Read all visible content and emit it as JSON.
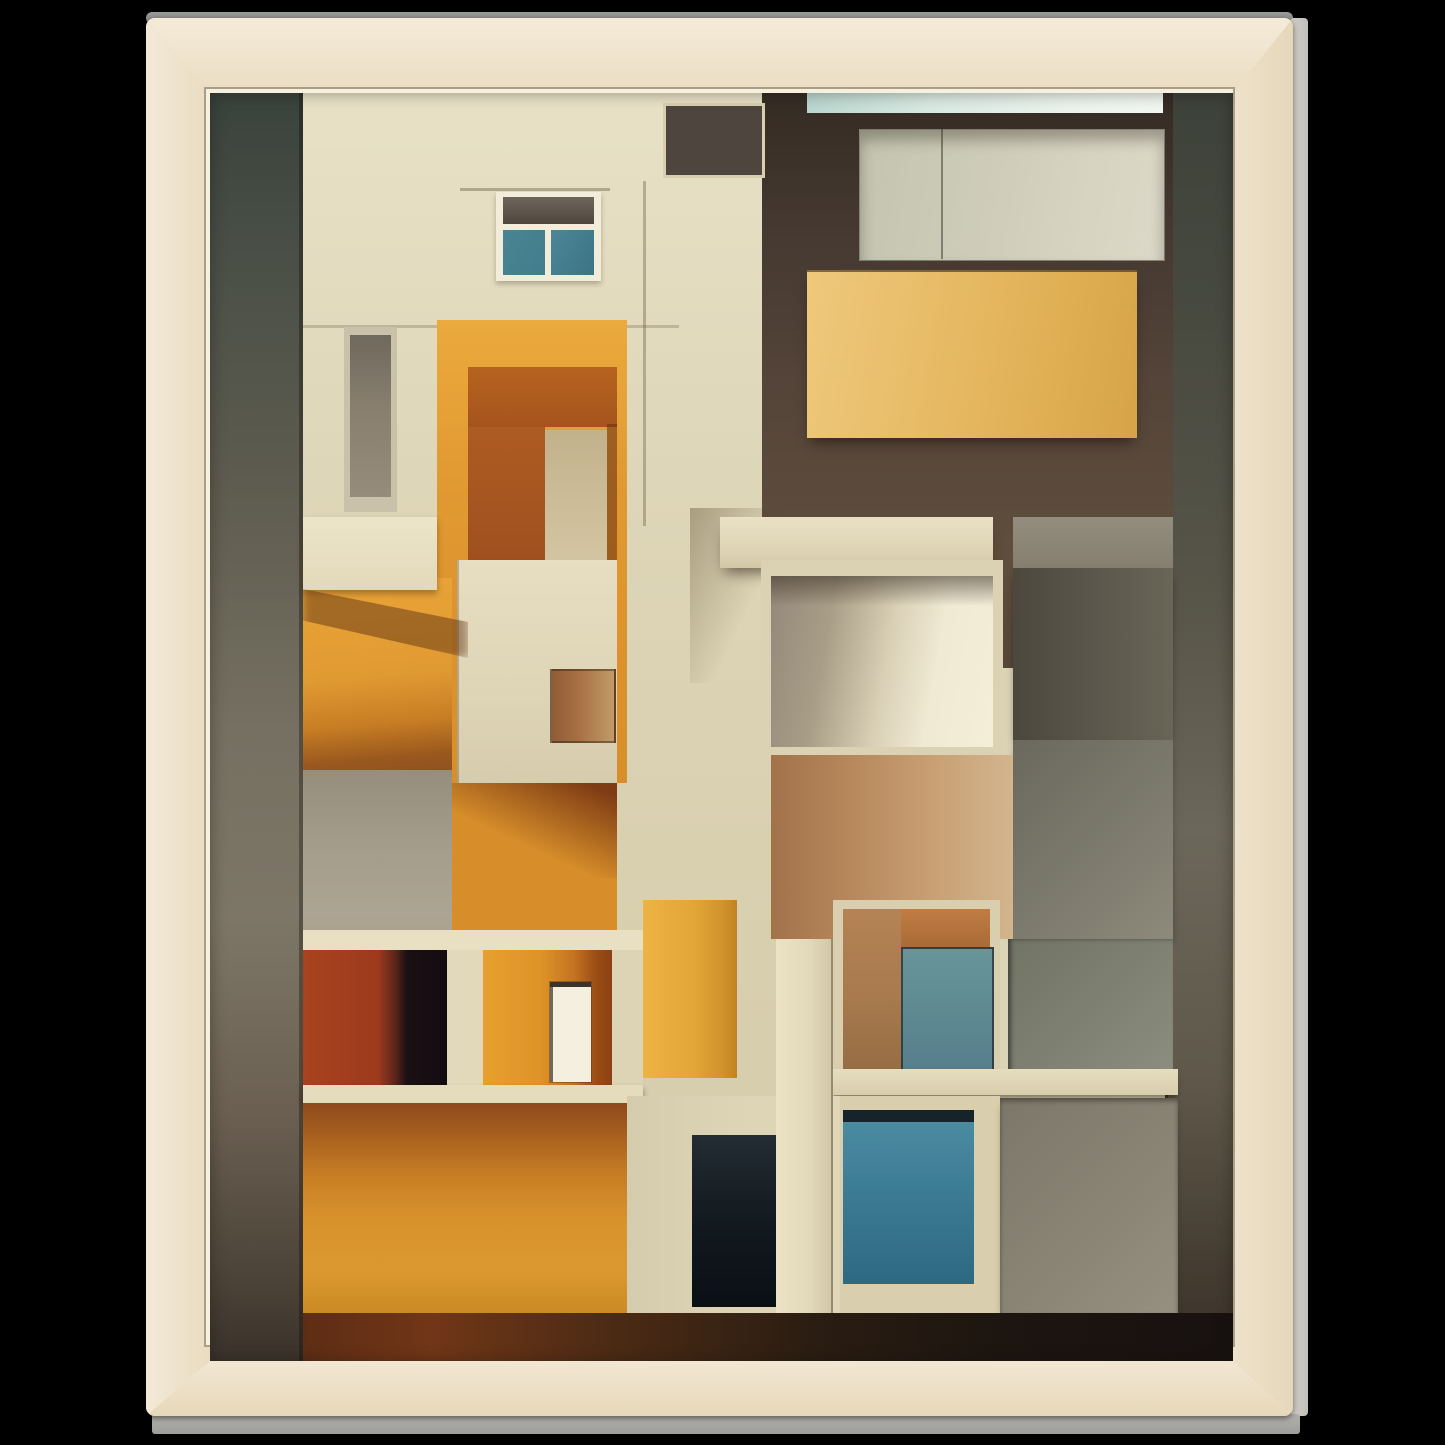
{
  "meta": {
    "kind": "framed-art-print-mockup",
    "background": "#000000"
  },
  "frame": {
    "wood_base": "#efe4cf",
    "wood_grain_dark": "#c79e72",
    "wood_grain_light": "#f8efe0",
    "top_edge_color": "#8e908d",
    "right_edge_color": "#c9c6c1",
    "bottom_edge_color": "#a7a6a3",
    "bevel_color": "#f6f0df"
  },
  "artwork": {
    "palette": {
      "cream": "#ded6b8",
      "orange": "#d88e29",
      "burnt_orange": "#a5541e",
      "amber_panel": "#e0b056",
      "teal_glass": "#3d7c95",
      "slate_strip": "#4a4c42",
      "dark_brown": "#4a3c30",
      "concrete_gray": "#a49c8a",
      "near_black": "#120c10"
    },
    "blocks": [
      {
        "name": "cream-facade-base",
        "x": 93,
        "y": 0,
        "w": 479,
        "h": 1270,
        "bg": "linear-gradient(180deg,#e8e1c6 0%,#ded6b8 30%,#d9d0b0 60%,#d4cba9 100%)",
        "cls": "grain-vsoft"
      },
      {
        "name": "left-sky-strip",
        "x": 0,
        "y": 0,
        "w": 93,
        "h": 1270,
        "bg": "linear-gradient(180deg,#39423c 0%,#494f46 12%,#5d5b4f 30%,#757061 50%,#7d7667 65%,#6b6052 80%,#4f463b 92%,#3a322a 100%)"
      },
      {
        "name": "left-strip-seam",
        "x": 89,
        "y": 0,
        "w": 4,
        "h": 1270,
        "bg": "rgba(15,15,10,0.35)"
      },
      {
        "name": "right-sky-strip",
        "x": 955,
        "y": 0,
        "w": 68,
        "h": 1270,
        "bg": "linear-gradient(180deg,#3d423a 0%,#484a40 18%,#585549 40%,#6b675a 58%,#5f584a 78%,#453d32 92%,#3b332a 100%)"
      },
      {
        "name": "right-strip-seam",
        "x": 955,
        "y": 0,
        "w": 3,
        "h": 1270,
        "bg": "rgba(10,10,8,0.4)"
      },
      {
        "name": "upper-right-brown-wall",
        "x": 552,
        "y": 0,
        "w": 411,
        "h": 575,
        "bg": "linear-gradient(180deg,#342b23 0%,#443830 22%,#544439 50%,#5f4e3d 80%,#574738 100%)"
      },
      {
        "name": "brown-wall-planks",
        "x": 552,
        "y": 330,
        "w": 411,
        "h": 245,
        "bg": "rgba(0,0,0,0)",
        "cls": "planks"
      },
      {
        "name": "rooftop-ice-strip",
        "x": 597,
        "y": 0,
        "w": 356,
        "h": 20,
        "bg": "linear-gradient(90deg,#b9d6ce 0%,#d9e9e2 35%,#ecf3ed 75%,#f1f6f0 100%)"
      },
      {
        "name": "top-right-pale-panel",
        "x": 649,
        "y": 36,
        "w": 304,
        "h": 130,
        "bg": "linear-gradient(100deg,#c3c4af 0%,#cccbb7 35%,#d6d3c1 70%,#dcd9c8 100%)",
        "border": "1px solid rgba(50,45,35,0.5)",
        "shadow": "inset 0 10px 14px rgba(40,32,22,0.35)"
      },
      {
        "name": "pale-panel-seam",
        "x": 731,
        "y": 36,
        "w": 2,
        "h": 130,
        "bg": "rgba(55,50,40,0.5)"
      },
      {
        "name": "amber-balcony-panel",
        "x": 597,
        "y": 177,
        "w": 330,
        "h": 168,
        "bg": "linear-gradient(100deg,#efc87c 0%,#e7bb66 40%,#dfae52 75%,#d7a348 100%)",
        "shadow": "0 8px 12px -4px rgba(25,15,8,0.6), inset 0 2px 0 rgba(40,25,10,0.55)"
      },
      {
        "name": "gray-stack-band",
        "x": 803,
        "y": 424,
        "w": 160,
        "h": 51,
        "bg": "linear-gradient(180deg,#938d7e,#867f70)"
      },
      {
        "name": "gray-square-dark",
        "x": 803,
        "y": 475,
        "w": 160,
        "h": 172,
        "bg": "linear-gradient(90deg,#4c483e 0%,#59554a 45%,#696557 100%)",
        "cls": "hlines",
        "shadow": "0 6px 9px -3px rgba(0,0,0,0.55)"
      },
      {
        "name": "gray-square-light",
        "x": 803,
        "y": 647,
        "w": 160,
        "h": 199,
        "bg": "linear-gradient(135deg,#6b685d 0%,#7b786c 50%,#8d8a7b 100%)",
        "shadow": "0 6px 9px -3px rgba(0,0,0,0.5)"
      },
      {
        "name": "column-diagonal-shadow",
        "x": 480,
        "y": 415,
        "w": 95,
        "h": 175,
        "bg": "linear-gradient(115deg,rgba(85,65,40,0.38) 0%,rgba(85,65,40,0) 60%)"
      },
      {
        "name": "concrete-beam",
        "x": 510,
        "y": 424,
        "w": 273,
        "h": 51,
        "bg": "linear-gradient(180deg,#eae0c5 0%,#ddd3b4 70%,#d2c7a5 100%)",
        "shadow": "0 10px 14px -5px rgba(45,30,18,0.6)"
      },
      {
        "name": "alcove-frame",
        "x": 551,
        "y": 467,
        "w": 242,
        "h": 203,
        "bg": "#dbd1b3"
      },
      {
        "name": "alcove-interior",
        "x": 561,
        "y": 483,
        "w": 222,
        "h": 171,
        "bg": "linear-gradient(100deg,#94897a 0%,#a89d86 26%,#d9d0b6 52%,#f0e9d3 72%,#f4eed9 100%)"
      },
      {
        "name": "alcove-top-shade",
        "x": 561,
        "y": 483,
        "w": 222,
        "h": 30,
        "bg": "linear-gradient(180deg,rgba(58,48,36,0.55),rgba(58,48,36,0))"
      },
      {
        "name": "tan-brick-wall",
        "x": 561,
        "y": 662,
        "w": 242,
        "h": 184,
        "bg": "linear-gradient(90deg,#a2734b 0%,#b8895d 35%,#c9a276 70%,#d3b58d 100%)",
        "cls": "bricks"
      },
      {
        "name": "glass-mesh-square",
        "x": 798,
        "y": 846,
        "w": 165,
        "h": 143,
        "bg": "linear-gradient(135deg,#717464 0%,#7e8172 50%,#8c8e7f 100%)",
        "cls": "mesh",
        "shadow": "inset 3px 0 4px rgba(15,20,15,0.5)"
      },
      {
        "name": "window-b-frame",
        "x": 623,
        "y": 807,
        "w": 167,
        "h": 178,
        "bg": "#d9cfaf",
        "cls": "grain-vsoft"
      },
      {
        "name": "window-b-lintel",
        "x": 633,
        "y": 816,
        "w": 147,
        "h": 40,
        "bg": "linear-gradient(180deg,#c07d43 0%,#a96a36 100%)"
      },
      {
        "name": "window-b-tan-wall",
        "x": 633,
        "y": 816,
        "w": 58,
        "h": 160,
        "bg": "linear-gradient(180deg,#b48356 0%,#a87a4e 55%,#976d43 100%)"
      },
      {
        "name": "window-b-teal-pane",
        "x": 691,
        "y": 854,
        "w": 89,
        "h": 122,
        "bg": "linear-gradient(180deg,#679599 0%,#567e8b 100%)",
        "cls": "blinds",
        "border": "2px solid rgba(25,30,32,0.65)"
      },
      {
        "name": "window-sill-band",
        "x": 620,
        "y": 976,
        "w": 348,
        "h": 26,
        "bg": "linear-gradient(180deg,#e6ddbf 0%,#d8cead 100%)",
        "shadow": "0 5px 7px -2px rgba(25,20,12,0.55)"
      },
      {
        "name": "window-c-frame",
        "x": 620,
        "y": 1003,
        "w": 170,
        "h": 224,
        "bg": "#d9cfaf",
        "cls": "grain-vsoft"
      },
      {
        "name": "window-c-top-bar",
        "x": 633,
        "y": 1017,
        "w": 131,
        "h": 12,
        "bg": "#17232b"
      },
      {
        "name": "window-c-teal-glass",
        "x": 633,
        "y": 1029,
        "w": 131,
        "h": 162,
        "bg": "linear-gradient(180deg,#4b8ba1 0%,#3d7c95 40%,#2e6982 100%)"
      },
      {
        "name": "bottom-right-gray-panel",
        "x": 790,
        "y": 1005,
        "w": 178,
        "h": 215,
        "bg": "linear-gradient(135deg,#7d776a 0%,#8a8475 55%,#959080 100%)",
        "shadow": "inset 0 3px 5px rgba(30,25,18,0.45), 0 6px 8px -3px rgba(0,0,0,0.4)"
      },
      {
        "name": "window-a-ledge-line",
        "x": 250,
        "y": 95,
        "w": 150,
        "h": 3,
        "bg": "rgba(95,85,62,0.4)"
      },
      {
        "name": "window-a-frame",
        "x": 286,
        "y": 99,
        "w": 105,
        "h": 89,
        "bg": "#f2ecda",
        "shadow": "0 3px 5px rgba(60,45,25,0.3)"
      },
      {
        "name": "window-a-transom",
        "x": 293,
        "y": 104,
        "w": 91,
        "h": 27,
        "bg": "linear-gradient(180deg,#6e665b 0%,#4f473e 100%)"
      },
      {
        "name": "window-a-pane-left",
        "x": 293,
        "y": 137,
        "w": 42,
        "h": 45,
        "bg": "linear-gradient(120deg,#4a8492 0%,#417d8c 100%)"
      },
      {
        "name": "window-a-pane-right",
        "x": 341,
        "y": 137,
        "w": 43,
        "h": 45,
        "bg": "linear-gradient(120deg,#4c8795 0%,#3c7386 100%)"
      },
      {
        "name": "facade-seam-horizontal",
        "x": 93,
        "y": 232,
        "w": 376,
        "h": 3,
        "bg": "rgba(125,112,82,0.35)"
      },
      {
        "name": "facade-seam-vertical",
        "x": 433,
        "y": 88,
        "w": 3,
        "h": 345,
        "bg": "rgba(110,98,70,0.4)"
      },
      {
        "name": "tall-window-frame",
        "x": 134,
        "y": 234,
        "w": 53,
        "h": 185,
        "bg": "#c9c1a9"
      },
      {
        "name": "tall-window-inner",
        "x": 140,
        "y": 242,
        "w": 41,
        "h": 162,
        "bg": "linear-gradient(180deg,#6f685c 0%,#887f6f 45%,#958c7b 100%)"
      },
      {
        "name": "doorway-orange-surround",
        "x": 227,
        "y": 227,
        "w": 190,
        "h": 463,
        "bg": "linear-gradient(180deg,#ebaa3d 0%,#e19932 35%,#d88e29 100%)"
      },
      {
        "name": "doorway-lintel",
        "x": 258,
        "y": 274,
        "w": 149,
        "h": 60,
        "bg": "linear-gradient(180deg,#b7631f 0%,#a5541e 100%)"
      },
      {
        "name": "doorway-jamb",
        "x": 258,
        "y": 334,
        "w": 77,
        "h": 330,
        "bg": "linear-gradient(180deg,#ad5c22 0%,#97491c 65%,#8b431d 100%)"
      },
      {
        "name": "doorway-brick-column",
        "x": 335,
        "y": 337,
        "w": 62,
        "h": 310,
        "bg": "linear-gradient(180deg,#c2b18b 0%,#d3c4a1 40%,#dccfae 100%)",
        "cls": "bricks-sm"
      },
      {
        "name": "doorway-dark-slot",
        "x": 397,
        "y": 331,
        "w": 10,
        "h": 316,
        "bg": "rgba(100,45,15,0.55)"
      },
      {
        "name": "tiled-grid-panel",
        "x": 247,
        "y": 467,
        "w": 160,
        "h": 226,
        "bg": "linear-gradient(180deg,#e7ddc1 0%,#ded4b6 60%,#d6ccad 100%)",
        "cls": "tiles",
        "shadow": "inset 2px 0 0 rgba(70,60,40,0.3)"
      },
      {
        "name": "tile-notch",
        "x": 340,
        "y": 576,
        "w": 62,
        "h": 70,
        "bg": "linear-gradient(90deg,#8f5c36 0%,#a97144 45%,#c29b68 100%)",
        "border": "2px solid rgba(40,30,20,0.45)"
      },
      {
        "name": "orange-left-wall",
        "x": 93,
        "y": 485,
        "w": 149,
        "h": 205,
        "bg": "linear-gradient(175deg,#e9a438 0%,#e09a32 48%,#c77d24 70%,#99581e 86%,#8a4e1e 100%)"
      },
      {
        "name": "concrete-lower-left",
        "x": 93,
        "y": 677,
        "w": 149,
        "h": 180,
        "bg": "linear-gradient(180deg,#968e7c 0%,#a49c8a 40%,#ada592 80%,#a89f8c 100%)"
      },
      {
        "name": "cream-balcony-box",
        "x": 93,
        "y": 424,
        "w": 134,
        "h": 73,
        "bg": "linear-gradient(180deg,#ede5c9 0%,#e2d9bb 100%)",
        "shadow": "0 4px 6px rgba(70,45,20,0.4)"
      },
      {
        "name": "balcony-shadow-sweep",
        "x": 93,
        "y": 490,
        "w": 165,
        "h": 75,
        "bg": "rgba(96,52,20,0.5)",
        "clip": "polygon(0 8%,100% 52%,100% 100%,0 50%)",
        "blur": 5
      },
      {
        "name": "orange-mid-wall",
        "x": 242,
        "y": 690,
        "w": 165,
        "h": 164,
        "bg": "#d78e2a"
      },
      {
        "name": "orange-mid-shadow",
        "x": 242,
        "y": 690,
        "w": 165,
        "h": 95,
        "bg": "linear-gradient(205deg,rgba(110,46,16,0.85) 8%,rgba(110,46,16,0) 62%)"
      },
      {
        "name": "rooms-top-beam",
        "x": 93,
        "y": 837,
        "w": 340,
        "h": 20,
        "bg": "#e9e0c3"
      },
      {
        "name": "room-red",
        "x": 93,
        "y": 857,
        "w": 144,
        "h": 135,
        "bg": "linear-gradient(90deg,#a8431f 0%,#9d3a1d 52%,#5e241b 64%,#1a1015 72%,#120c10 100%)"
      },
      {
        "name": "room-mullion",
        "x": 237,
        "y": 857,
        "w": 36,
        "h": 135,
        "bg": "#e2d9bb"
      },
      {
        "name": "room-orange",
        "x": 273,
        "y": 857,
        "w": 129,
        "h": 135,
        "bg": "linear-gradient(90deg,#e7a02e 0%,#de9328 45%,#c57420 70%,#9a4d15 88%,#8a4212 100%)"
      },
      {
        "name": "room-white-door",
        "x": 340,
        "y": 889,
        "w": 41,
        "h": 100,
        "bg": "#f4efdf",
        "shadow": "inset 0 5px 0 #3b342c, inset 3px 0 0 #6f675d, 0 0 0 1px rgba(60,50,40,0.4)"
      },
      {
        "name": "room-pillar",
        "x": 402,
        "y": 857,
        "w": 31,
        "h": 135,
        "bg": "#ddd3b5"
      },
      {
        "name": "golden-wood-panel",
        "x": 433,
        "y": 807,
        "w": 94,
        "h": 178,
        "bg": "linear-gradient(90deg,#edb345 0%,#e2a537 55%,#d0922c 85%,#c08324 100%)",
        "cls": "grain-v"
      },
      {
        "name": "rooms-ledge",
        "x": 93,
        "y": 992,
        "w": 340,
        "h": 18,
        "bg": "#e5dcbe",
        "shadow": "0 4px 6px rgba(40,25,10,0.45)"
      },
      {
        "name": "big-orange-wall",
        "x": 93,
        "y": 1010,
        "w": 324,
        "h": 210,
        "bg": "linear-gradient(180deg,#8e4a1c 0%,#a55d1e 14%,#c67d24 34%,#d8922c 55%,#db9830 80%,#cc8a24 100%)"
      },
      {
        "name": "bottom-cream-panel",
        "x": 417,
        "y": 1003,
        "w": 213,
        "h": 220,
        "bg": "linear-gradient(90deg,#d5cbad 0%,#ddd3b5 50%,#e0d6b8 100%)",
        "cls": "grain-vsoft"
      },
      {
        "name": "bottom-dark-doorway",
        "x": 482,
        "y": 1042,
        "w": 88,
        "h": 172,
        "bg": "linear-gradient(180deg,#232c33 0%,#11181e 55%,#0a0f14 100%)"
      },
      {
        "name": "cream-post",
        "x": 566,
        "y": 846,
        "w": 57,
        "h": 374,
        "bg": "linear-gradient(90deg,#ece2c4 0%,#e2d8ba 60%,#d1c6a5 100%)",
        "cls": "grain-vsoft",
        "shadow": "inset -2px 0 0 rgba(60,50,35,0.4)"
      },
      {
        "name": "bottom-shadow-strip",
        "x": 93,
        "y": 1220,
        "w": 930,
        "h": 50,
        "bg": "linear-gradient(90deg,#5e2d15 0%,#703617 14%,#4a2a14 34%,#2a1d12 55%,#1d1510 75%,#171110 100%)"
      },
      {
        "name": "roof-vent-louver",
        "x": 456,
        "y": 13,
        "w": 96,
        "h": 69,
        "bg": "#4e463e",
        "cls": "louver",
        "shadow": "0 0 0 3px #d9cfb0"
      },
      {
        "name": "artwork-vignette",
        "x": 0,
        "y": 0,
        "w": 1023,
        "h": 1270,
        "bg": "rgba(0,0,0,0)",
        "shadow": "inset 0 0 16px rgba(20,15,10,0.4)"
      }
    ]
  }
}
